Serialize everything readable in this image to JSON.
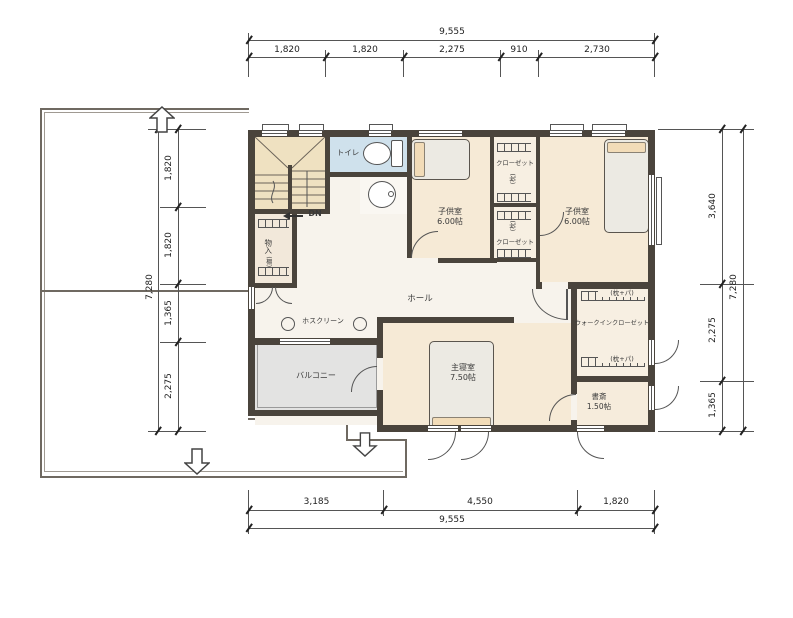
{
  "dimensions": {
    "top": {
      "total": "9,555",
      "segments": [
        "1,820",
        "1,820",
        "2,275",
        "910",
        "2,730"
      ]
    },
    "bottom": {
      "total": "9,555",
      "segments": [
        "3,185",
        "4,550",
        "1,820"
      ]
    },
    "left": {
      "total": "7,280",
      "segments": [
        "1,820",
        "1,820",
        "1,365",
        "2,275"
      ]
    },
    "right": {
      "total": "7,280",
      "segments": [
        "3,640",
        "2,275",
        "1,365"
      ]
    }
  },
  "rooms": {
    "stairs": {
      "down_label": "DN"
    },
    "storage": {
      "label": "物入",
      "note": "(棚)"
    },
    "toilet": {
      "label": "トイレ"
    },
    "kids_room_left": {
      "label": "子供室",
      "size": "6.00帖"
    },
    "kids_room_right": {
      "label": "子供室",
      "size": "6.00帖"
    },
    "closet_upper": {
      "label": "クローゼット",
      "note": "(枕)"
    },
    "closet_lower": {
      "label": "クローゼット",
      "note": "(枕)"
    },
    "hall": {
      "label": "ホール"
    },
    "laundry_pole": {
      "label": "ホスクリーン"
    },
    "balcony": {
      "label": "バルコニー"
    },
    "master_bedroom": {
      "label": "主寝室",
      "size": "7.50帖"
    },
    "walk_in_closet": {
      "label": "ウォークインクローゼット",
      "note_top": "(枕+パ)",
      "note_bottom": "(枕+パ)"
    },
    "study": {
      "label": "書斎",
      "size": "1.50帖"
    }
  },
  "colors": {
    "wall": "#4a443c",
    "room-cream": "#f6ead6",
    "room-light": "#f7efe2",
    "stairs": "#efe1c1",
    "toilet": "#cfe1ec",
    "balcony": "#e3e3e2",
    "hall": "#f7f3ec",
    "line": "#3a3a3a",
    "bed": "#eceae3",
    "pillow": "#f2dcb8"
  }
}
